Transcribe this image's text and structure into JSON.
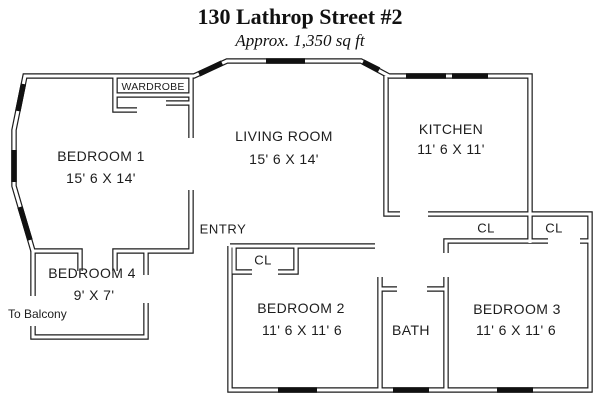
{
  "header": {
    "title": "130 Lathrop Street #2",
    "subtitle": "Approx. 1,350 sq ft"
  },
  "rooms": {
    "bedroom1": {
      "label": "BEDROOM 1",
      "dims": "15' 6 X 14'"
    },
    "living_room": {
      "label": "LIVING ROOM",
      "dims": "15' 6 X 14'"
    },
    "kitchen": {
      "label": "KITCHEN",
      "dims": "11' 6 X 11'"
    },
    "bedroom2": {
      "label": "BEDROOM 2",
      "dims": "11' 6 X 11' 6"
    },
    "bedroom3": {
      "label": "BEDROOM 3",
      "dims": "11' 6 X 11' 6"
    },
    "bedroom4": {
      "label": "BEDROOM 4",
      "dims": "9' X 7'"
    },
    "bath": {
      "label": "BATH"
    },
    "entry": {
      "label": "ENTRY"
    },
    "wardrobe": {
      "label": "WARDROBE"
    },
    "closet_bedroom2": {
      "label": "CL"
    },
    "closet_hall": {
      "label": "CL"
    },
    "closet_bedroom3": {
      "label": "CL"
    }
  },
  "annotations": {
    "to_balcony": "To Balcony"
  },
  "colors": {
    "walls": "#1c1c1c",
    "windows": "#111111",
    "background": "#ffffff",
    "text": "#1a1a1a"
  }
}
